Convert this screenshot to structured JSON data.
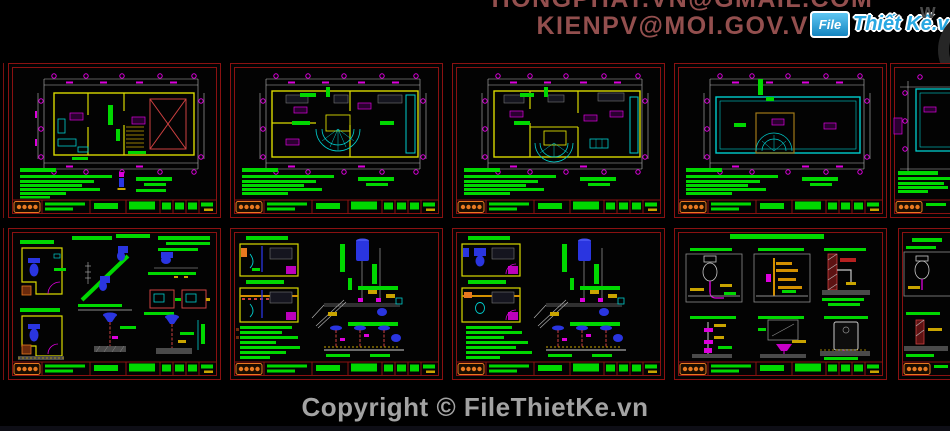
{
  "header": {
    "email_line_1": "HONGPHAT.VN@GMAIL.COM",
    "email_line_2": "KIENPV@MOI.GOV.VN",
    "logo_file": "File",
    "logo_name": "Thiết Kế.vn",
    "watermark_letter": "w"
  },
  "footer": {
    "copyright": "Copyright © FileThietKe.vn"
  },
  "colors": {
    "background": "#000000",
    "sheet_border_red": "#8a1111",
    "email_text": "#934f4e",
    "copyright_text": "#a3a3a3",
    "logo_blue": "#29a8e2",
    "cad_green": "#00d800",
    "cad_yellow": "#d9d900",
    "cad_cyan": "#00cdcd",
    "cad_magenta": "#dd00dd",
    "cad_blue": "#2a35e0",
    "cad_red": "#cc4040",
    "cad_white": "#b9b9b9",
    "cad_logo_orange": "#e87820"
  }
}
